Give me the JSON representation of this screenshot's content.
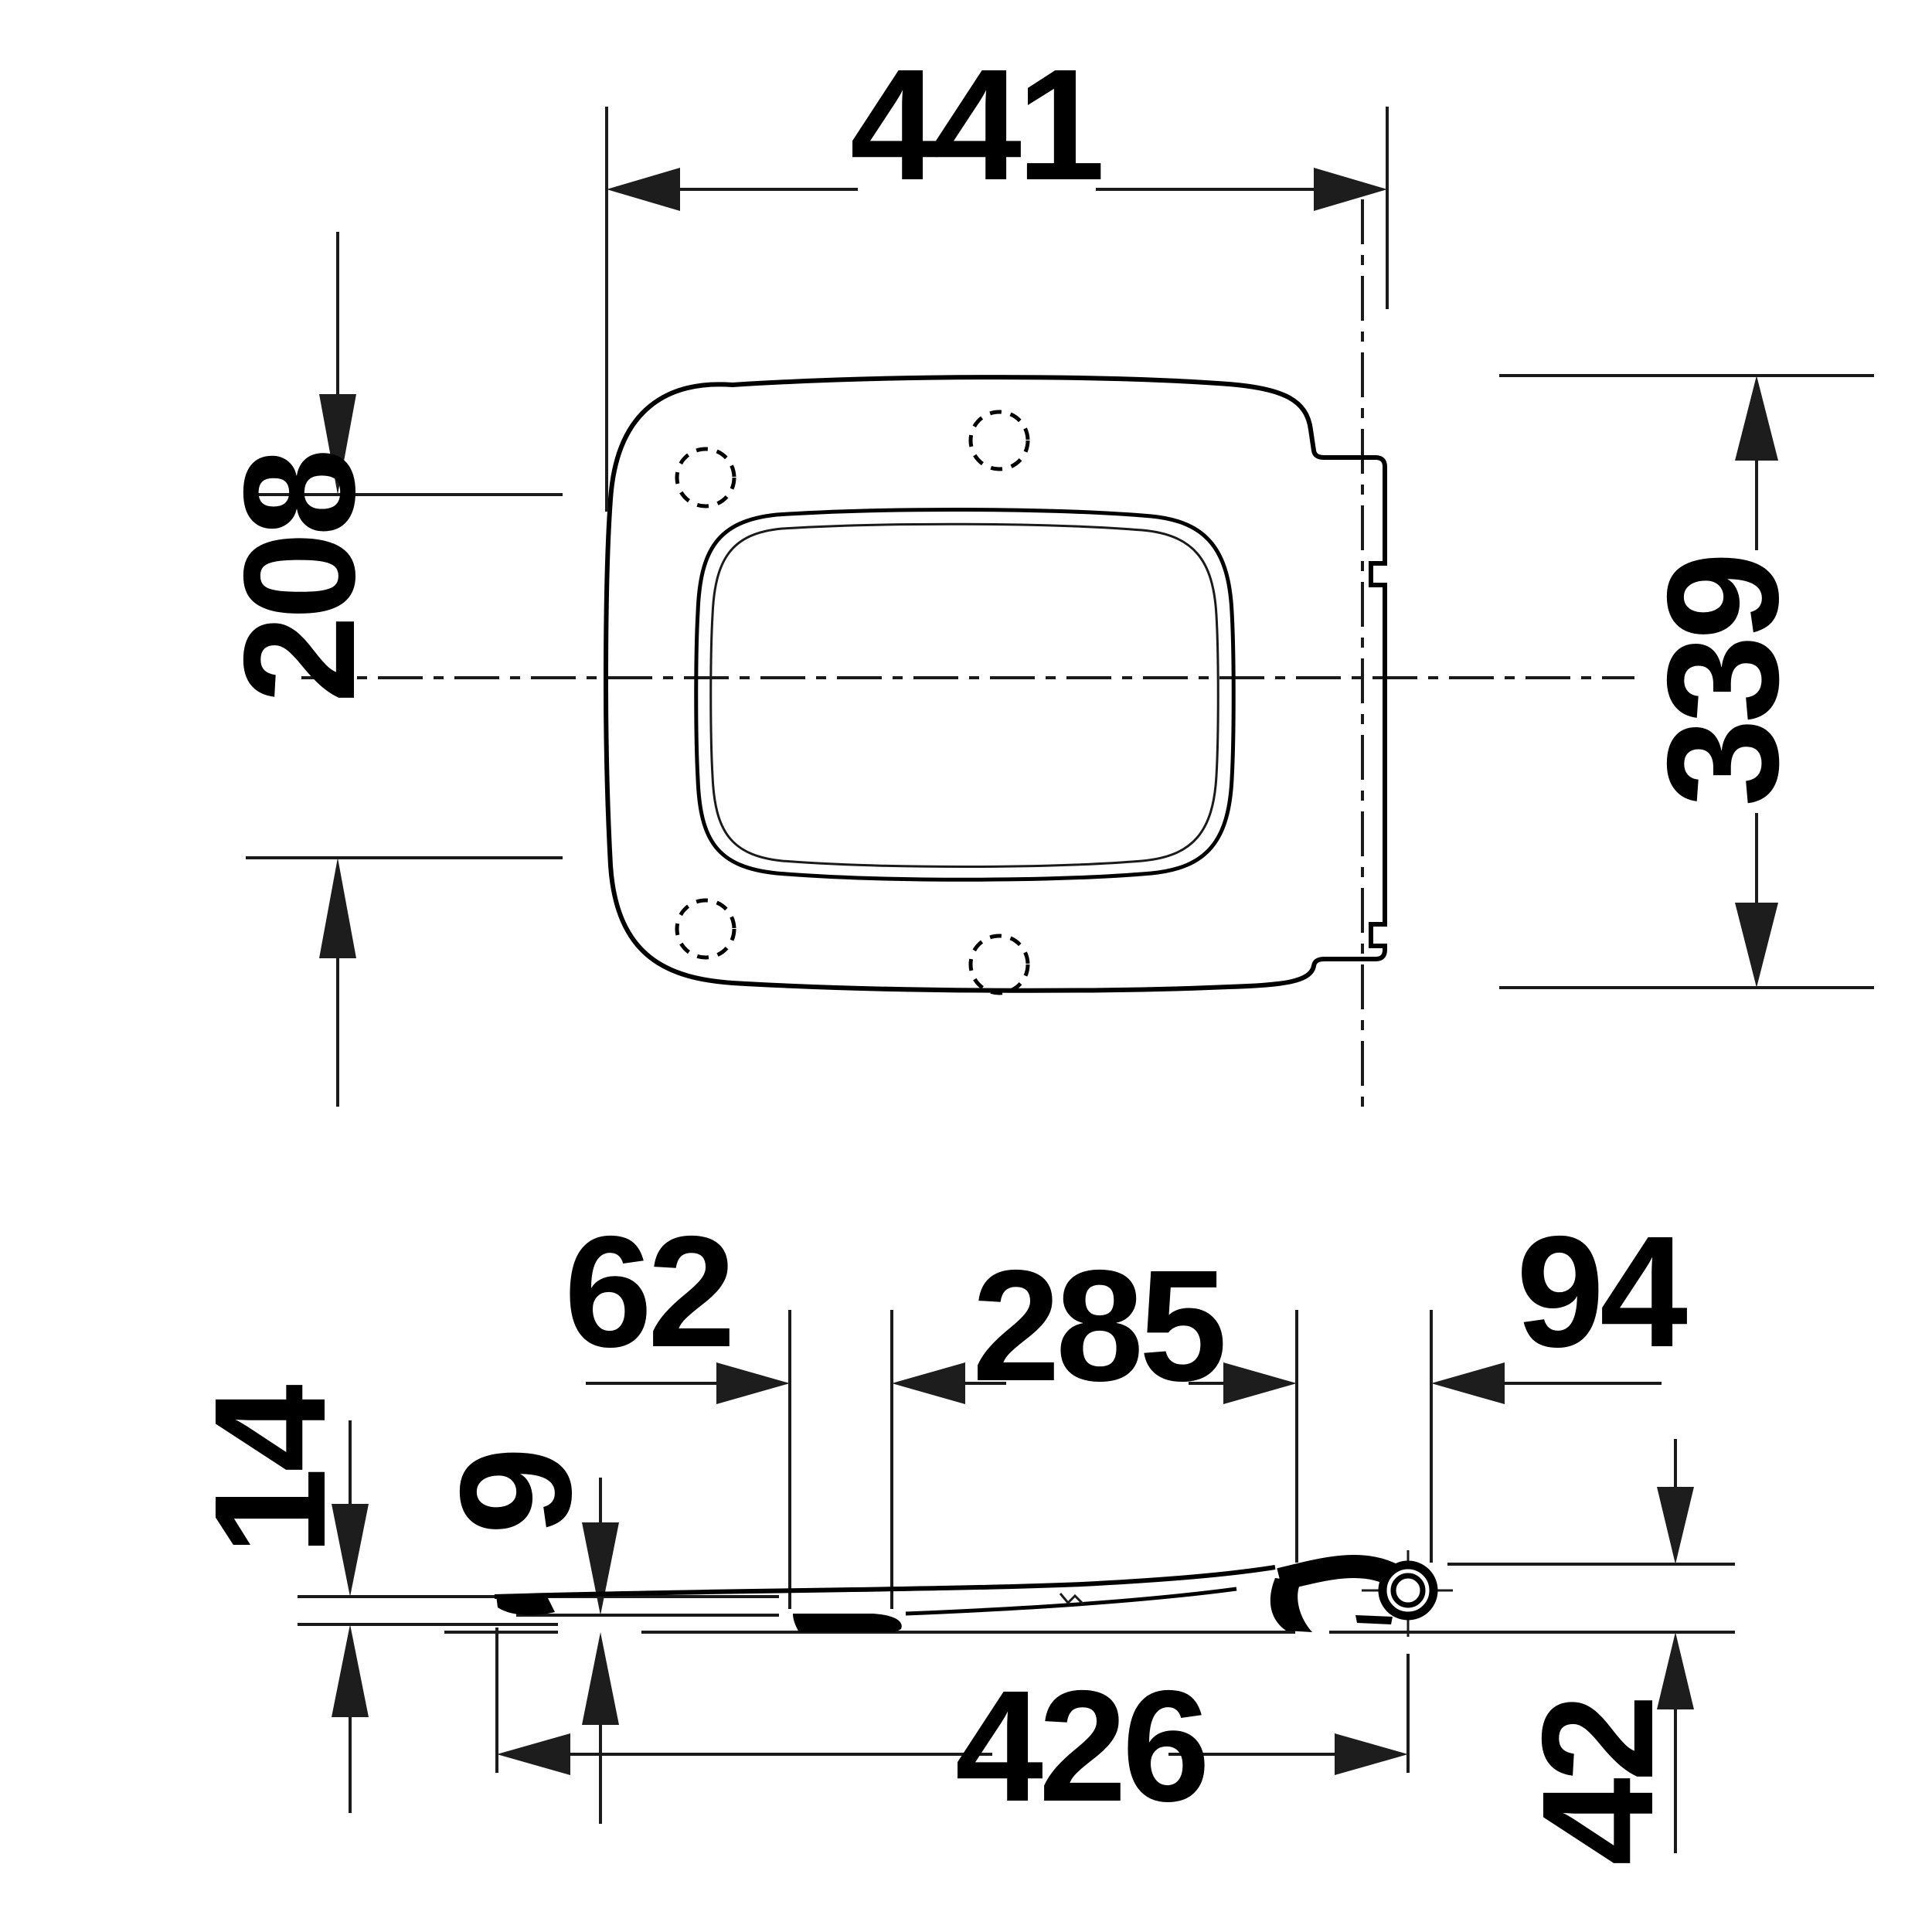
{
  "colors": {
    "ink": "#000000",
    "line": "#1a1a1a",
    "background": "#ffffff"
  },
  "top_view": {
    "dimensions": {
      "overall_width": {
        "value": "441"
      },
      "front_section_depth": {
        "value": "208"
      },
      "overall_depth": {
        "value": "339"
      }
    }
  },
  "side_view": {
    "dimensions": {
      "buffer_offset": {
        "value": "62"
      },
      "buffer_to_hinge": {
        "value": "285"
      },
      "hinge_overhang": {
        "value": "94"
      },
      "front_height": {
        "value": "14"
      },
      "seat_thickness": {
        "value": "9"
      },
      "seat_length": {
        "value": "426"
      },
      "hinge_height": {
        "value": "42"
      }
    }
  }
}
